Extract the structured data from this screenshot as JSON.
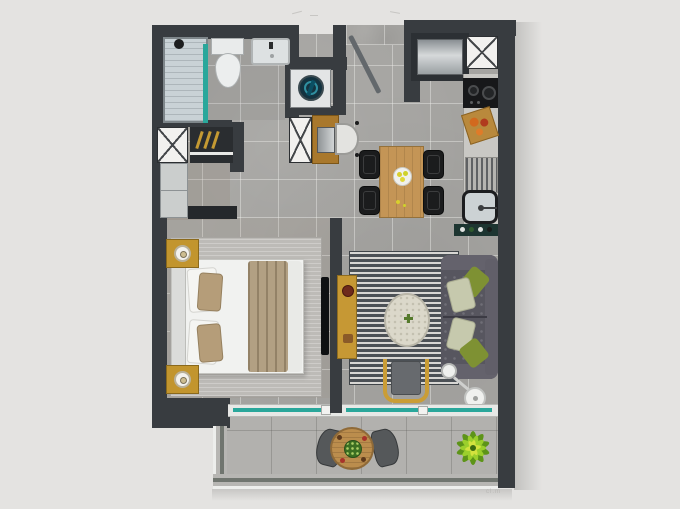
{
  "scene": {
    "kind": "apartment-floor-plan",
    "style": "top-down 3d rendered plan, no text labels",
    "watermark": "cl.m"
  },
  "palette": {
    "background": "#e4e3e1",
    "wall": "#383c40",
    "floor_tile": "#a5a4a1",
    "balcony_tile": "#b2b1ae",
    "glass_teal": "#2aa79b",
    "wood": "#c49556",
    "gold_accent": "#c2952e",
    "bed_linen_white": "#f1f2f0",
    "blanket_tan": "#b2a083",
    "sofa_gray": "#57565f",
    "pillow_green": "#7e9133",
    "pillow_sage": "#c6c9ad",
    "rug_stripe_dark": "#4c5156",
    "rug_stripe_light": "#d8d7d4",
    "plant_green": "#8abf28",
    "fixture_white": "#eceeee"
  },
  "rooms": [
    {
      "id": "bathroom",
      "furniture": [
        "shower",
        "toilet",
        "sink",
        "duct-shaft"
      ]
    },
    {
      "id": "dressing-area",
      "furniture": [
        "wardrobe-hangers",
        "cabinet",
        "dresser"
      ]
    },
    {
      "id": "laundry-nook",
      "furniture": [
        "washing-machine",
        "tall-cabinet",
        "desk",
        "laptop",
        "desk-chair"
      ]
    },
    {
      "id": "entry",
      "furniture": [
        "entry-door-open"
      ]
    },
    {
      "id": "kitchen",
      "furniture": [
        "fridge",
        "duct-shaft",
        "cooktop",
        "cutting-board",
        "drying-rack",
        "sink",
        "bottle-shelf"
      ]
    },
    {
      "id": "dining",
      "furniture": [
        "wood-table",
        "chair",
        "chair",
        "chair",
        "chair",
        "fruit-plate"
      ]
    },
    {
      "id": "bedroom",
      "furniture": [
        "double-bed",
        "nightstand-lamp",
        "nightstand-lamp",
        "rug",
        "tv-wall-mounted"
      ]
    },
    {
      "id": "living-room",
      "furniture": [
        "striped-rug",
        "sofa",
        "green-pillows",
        "coffee-table",
        "armchair",
        "arc-floor-lamp",
        "console"
      ]
    },
    {
      "id": "balcony",
      "furniture": [
        "sliding-glass-doors",
        "bistro-table",
        "chair",
        "chair",
        "potted-plant",
        "railing"
      ]
    }
  ]
}
